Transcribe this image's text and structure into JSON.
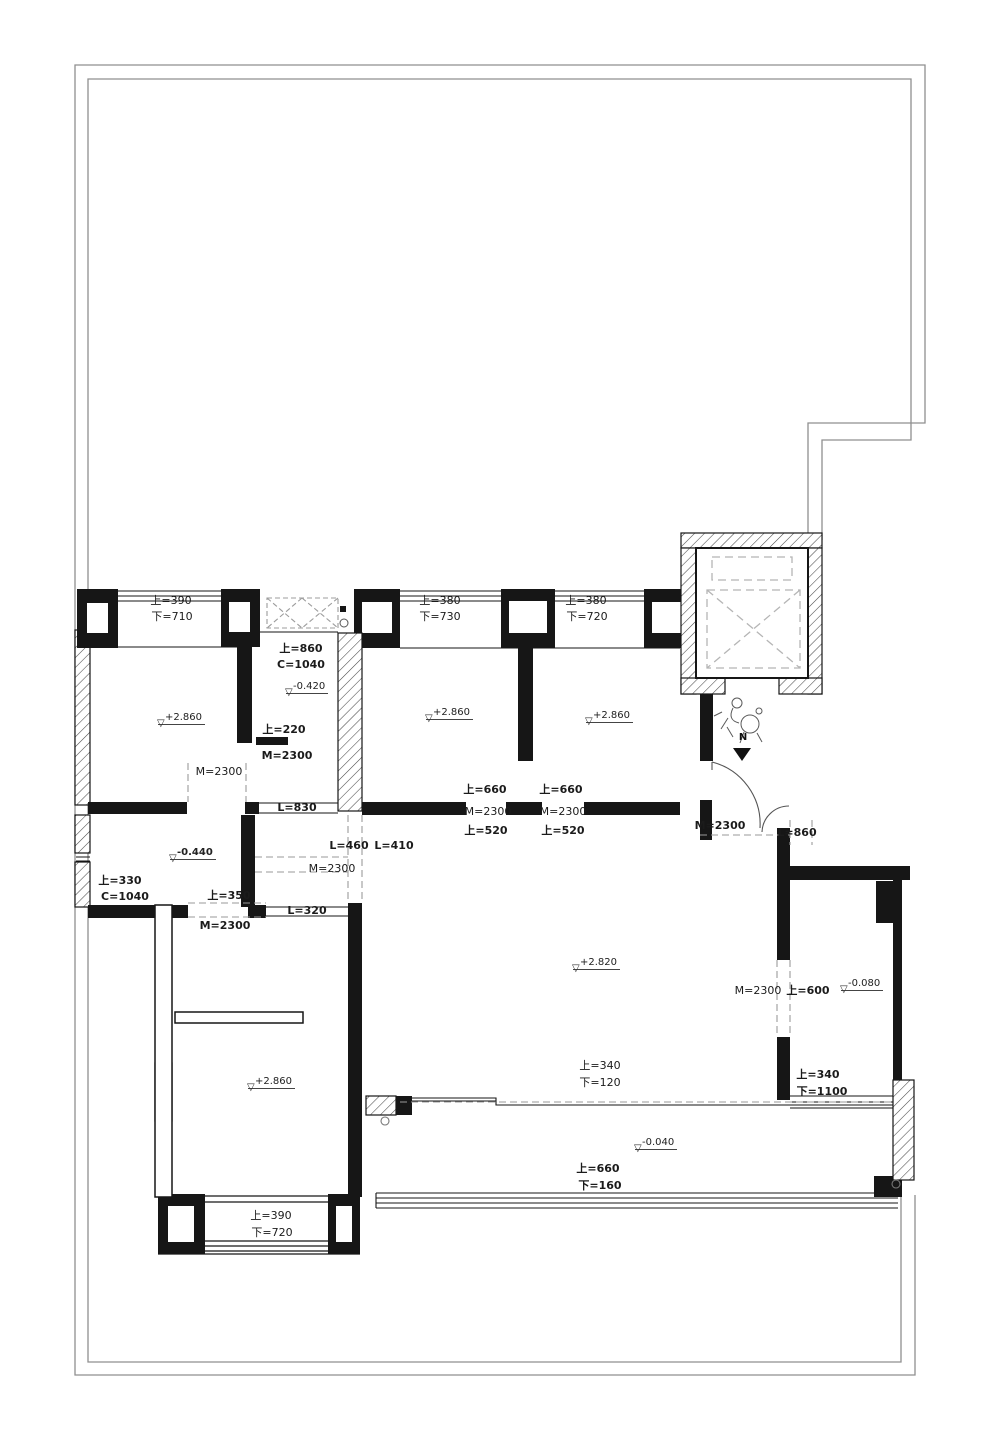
{
  "document": {
    "type": "architectural-floor-plan",
    "language": "zh-CN"
  },
  "colors": {
    "wall_line": "#161616",
    "site_boundary": "#8f8f8f",
    "dashed_opening": "#999999",
    "background": "#ffffff"
  },
  "icons": {
    "elevation_marker": "▽",
    "north_arrow_head": "▼"
  },
  "north_arrow": {
    "label": "N"
  },
  "elevation_marks": [
    {
      "value": "+2.860",
      "bold": false
    },
    {
      "value": "-0.420",
      "bold": false
    },
    {
      "value": "+2.860",
      "bold": false
    },
    {
      "value": "+2.860",
      "bold": false
    },
    {
      "value": "-0.440",
      "bold": true
    },
    {
      "value": "+2.820",
      "bold": false
    },
    {
      "value": "-0.080",
      "bold": false
    },
    {
      "value": "-0.040",
      "bold": false
    },
    {
      "value": "+2.860",
      "bold": false
    }
  ],
  "labels": [
    {
      "text": "上=390",
      "bold": false
    },
    {
      "text": "下=710",
      "bold": false
    },
    {
      "text": "上=380",
      "bold": false
    },
    {
      "text": "下=730",
      "bold": false
    },
    {
      "text": "上=380",
      "bold": false
    },
    {
      "text": "下=720",
      "bold": false
    },
    {
      "text": "上=860",
      "bold": true
    },
    {
      "text": "C=1040",
      "bold": true
    },
    {
      "text": "上=220",
      "bold": true
    },
    {
      "text": "M=2300",
      "bold": true
    },
    {
      "text": "M=2300",
      "bold": false
    },
    {
      "text": "上=660",
      "bold": true
    },
    {
      "text": "M=2300",
      "bold": false
    },
    {
      "text": "上=520",
      "bold": true
    },
    {
      "text": "上=660",
      "bold": true
    },
    {
      "text": "M=2300",
      "bold": false
    },
    {
      "text": "上=520",
      "bold": true
    },
    {
      "text": "L=830",
      "bold": true
    },
    {
      "text": "L=460",
      "bold": true
    },
    {
      "text": "L=410",
      "bold": true
    },
    {
      "text": "M=2300",
      "bold": false
    },
    {
      "text": "L=320",
      "bold": true
    },
    {
      "text": "上=330",
      "bold": true
    },
    {
      "text": "C=1040",
      "bold": true
    },
    {
      "text": "上=350",
      "bold": true
    },
    {
      "text": "M=2300",
      "bold": true
    },
    {
      "text": "M=2300",
      "bold": true
    },
    {
      "text": "L=860",
      "bold": true
    },
    {
      "text": "M=2300",
      "bold": false
    },
    {
      "text": "上=600",
      "bold": true
    },
    {
      "text": "上=340",
      "bold": true
    },
    {
      "text": "下=1100",
      "bold": true
    },
    {
      "text": "上=340",
      "bold": false
    },
    {
      "text": "下=120",
      "bold": false
    },
    {
      "text": "上=660",
      "bold": true
    },
    {
      "text": "下=160",
      "bold": true
    },
    {
      "text": "上=390",
      "bold": false
    },
    {
      "text": "下=720",
      "bold": false
    }
  ]
}
